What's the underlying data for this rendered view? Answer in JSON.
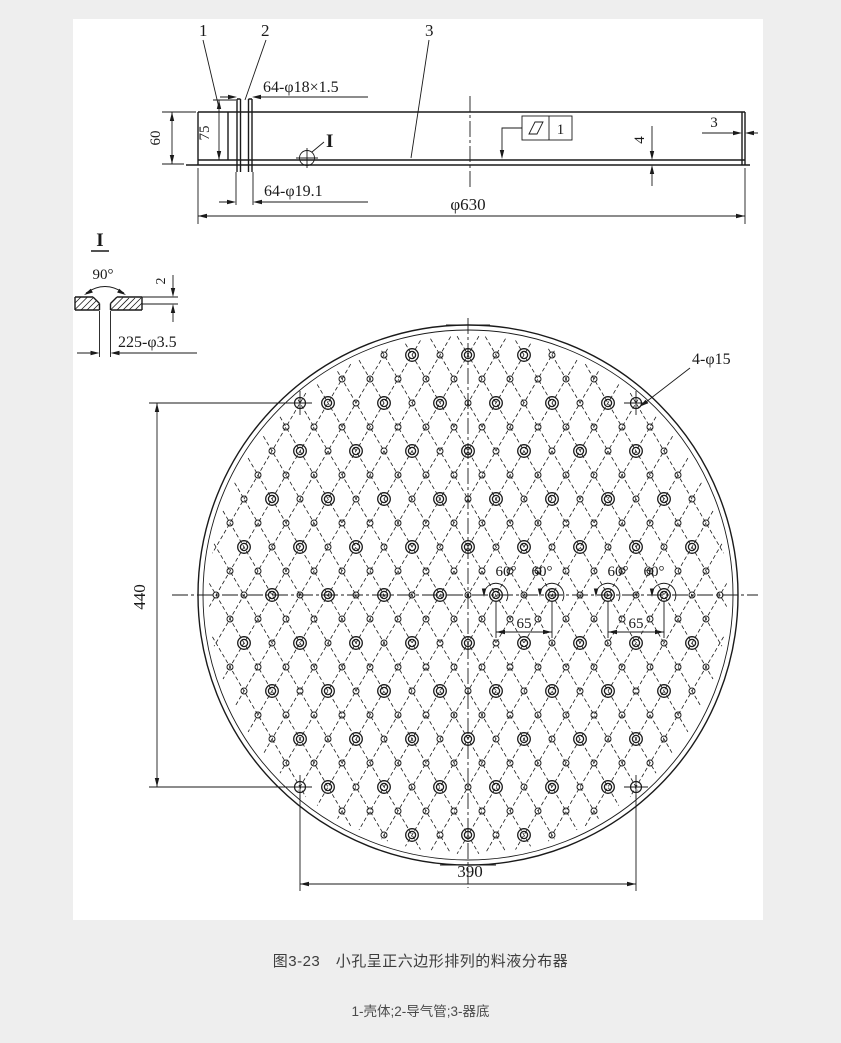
{
  "page": {
    "background": "#eeeeee",
    "paper": "#ffffff",
    "ink": "#1a1a1a"
  },
  "captions": {
    "figure": "图3-23　小孔呈正六边形排列的料液分布器",
    "legend": "1-壳体;2-导气管;3-器底"
  },
  "side_view": {
    "part_label_1": "1",
    "part_label_2": "2",
    "part_label_3": "3",
    "dim_tube_spec": "64-φ18×1.5",
    "dim_hole_spec": "64-φ19.1",
    "dim_rim_height": "60",
    "dim_tube_height": "75",
    "dim_outer_diameter": "φ630",
    "dim_bottom_thickness": "4",
    "dim_wall_thickness": "3",
    "detail_mark": "I",
    "tolerance_datum": "1"
  },
  "detail_view": {
    "title": "I",
    "dim_countersink_angle": "90°",
    "dim_countersink_depth": "2",
    "dim_small_holes": "225-φ3.5"
  },
  "plan_view": {
    "dim_corner_holes": "4-φ15",
    "dim_height": "440",
    "dim_width": "390",
    "dim_pitch_left": "65",
    "dim_pitch_right": "65",
    "angle_labels": [
      "60°",
      "60°",
      "60°",
      "60°"
    ]
  },
  "pattern": {
    "cx": 468,
    "cy": 595,
    "r_outer": 270,
    "r_inner": 265,
    "pitch_x": 28,
    "pitch_y": 24,
    "r_line_clip": 259,
    "r_small": 3,
    "r_large": 6.3,
    "r_large_inner": 3.6,
    "max_r_small": 256,
    "max_r_large": 249,
    "corner_holes": [
      [
        300,
        403
      ],
      [
        636,
        403
      ],
      [
        300,
        787
      ],
      [
        636,
        787
      ]
    ],
    "corner_hole_r": 5.5,
    "arc_hole_xs": [
      496,
      552,
      608,
      664
    ]
  }
}
